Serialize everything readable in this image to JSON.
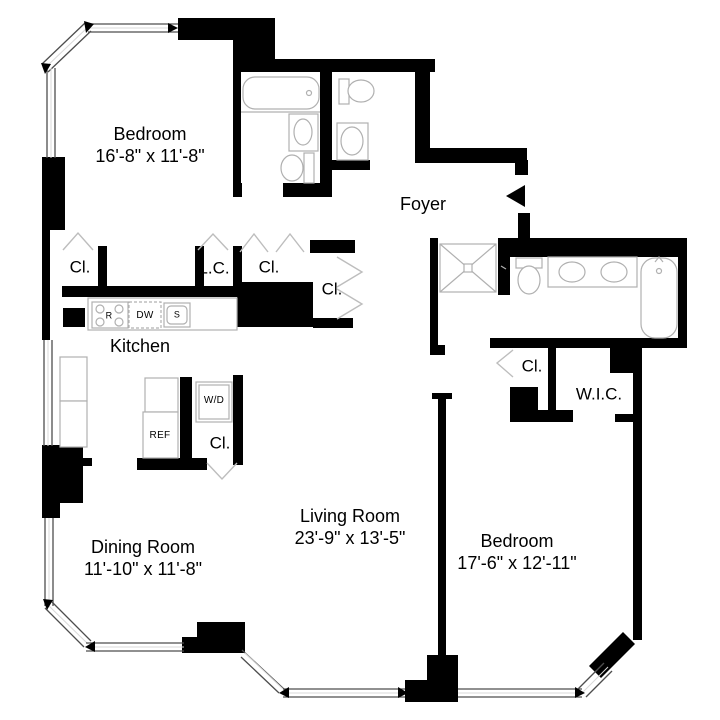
{
  "title": "Two Bedroom Apartment Floor Plan",
  "rooms": {
    "bedroom1": {
      "name": "Bedroom",
      "dims": "16'-8\" x 11'-8\""
    },
    "foyer": {
      "name": "Foyer"
    },
    "kitchen": {
      "name": "Kitchen"
    },
    "dining": {
      "name": "Dining Room",
      "dims": "11'-10\" x 11'-8\""
    },
    "living": {
      "name": "Living Room",
      "dims": "23'-9\" x 13'-5\""
    },
    "bedroom2": {
      "name": "Bedroom",
      "dims": "17'-6\" x 12'-11\""
    },
    "wic": {
      "name": "W.I.C."
    }
  },
  "closets": {
    "bedroom1_closet": "Cl.",
    "linen_closet": "L.C.",
    "hall_closet": "Cl.",
    "foyer_closet": "Cl.",
    "laundry_closet": "Cl.",
    "bedroom2_closet": "Cl."
  },
  "appliances": {
    "range": "R",
    "dishwasher": "DW",
    "sink": "S",
    "washer_dryer": "W/D",
    "refrigerator": "REF"
  },
  "colors": {
    "wall": "#000000",
    "fixture_outline": "#b0b0b0",
    "window_line": "#4d4d4d",
    "background": "#ffffff"
  }
}
